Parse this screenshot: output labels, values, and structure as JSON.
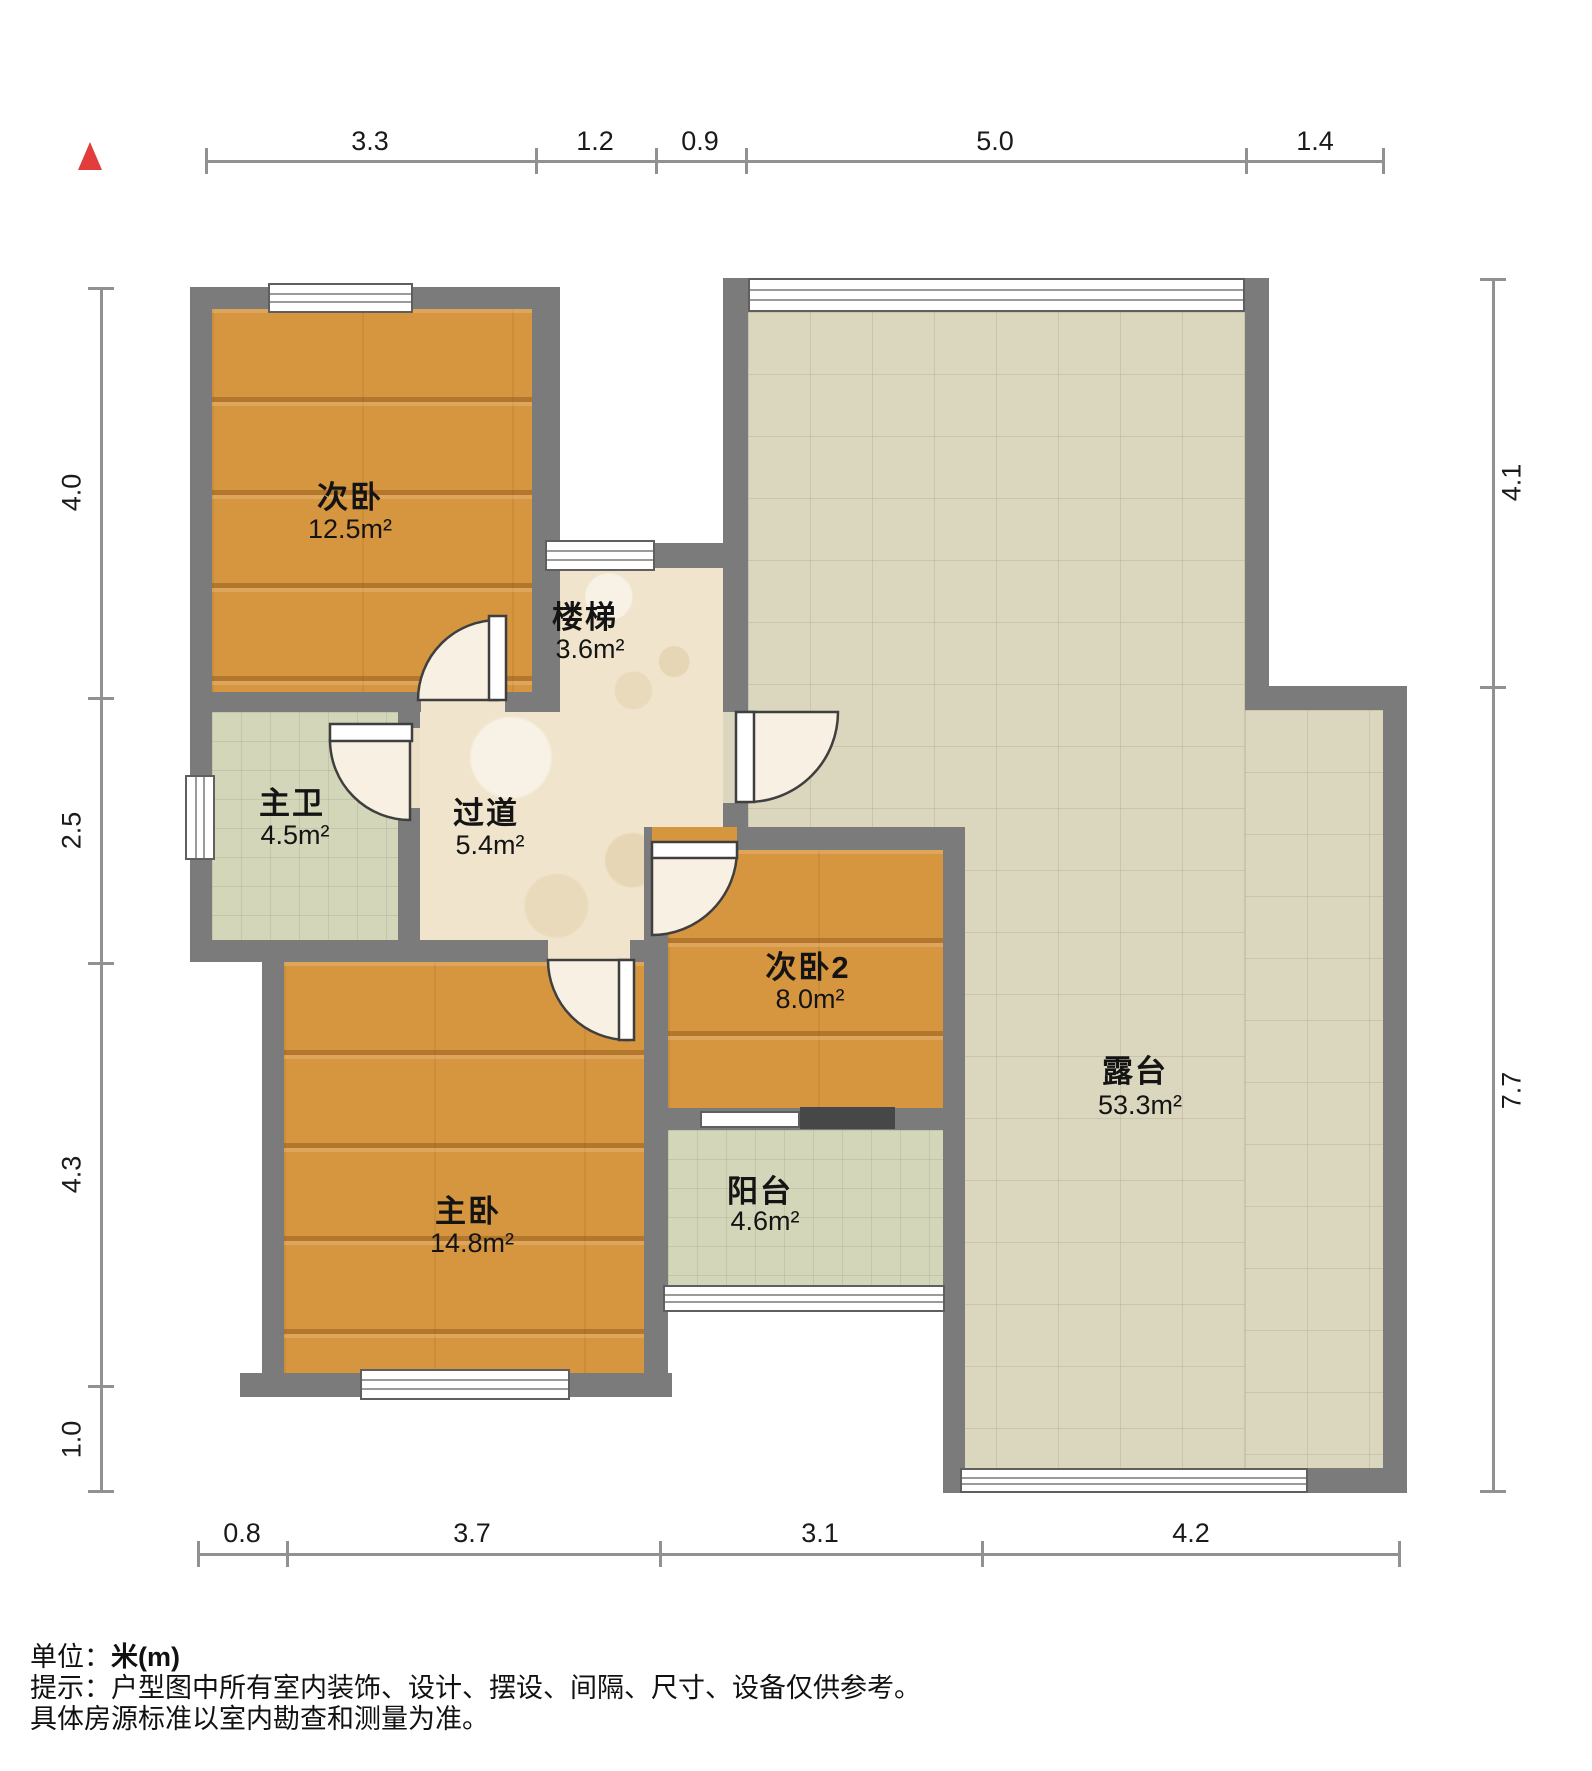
{
  "rooms": {
    "bedroom2": {
      "name": "次卧",
      "area": "12.5m²"
    },
    "stairs": {
      "name": "楼梯",
      "area": "3.6m²"
    },
    "master_bath": {
      "name": "主卫",
      "area": "4.5m²"
    },
    "corridor": {
      "name": "过道",
      "area": "5.4m²"
    },
    "bedroom3": {
      "name": "次卧2",
      "area": "8.0m²"
    },
    "master_bedroom": {
      "name": "主卧",
      "area": "14.8m²"
    },
    "balcony": {
      "name": "阳台",
      "area": "4.6m²"
    },
    "terrace": {
      "name": "露台",
      "area": "53.3m²"
    }
  },
  "dimensions": {
    "top": [
      "3.3",
      "1.2",
      "0.9",
      "5.0",
      "1.4"
    ],
    "left": [
      "4.0",
      "2.5",
      "4.3",
      "1.0"
    ],
    "right": [
      "4.1",
      "7.7"
    ],
    "bottom": [
      "0.8",
      "3.7",
      "3.1",
      "4.2"
    ]
  },
  "footer": {
    "unit_prefix": "单位：",
    "unit_value": "米(m)",
    "tip_line1": "提示：户型图中所有室内装饰、设计、摆设、间隔、尺寸、设备仅供参考。",
    "tip_line2": "具体房源标准以室内勘查和测量为准。"
  },
  "colors": {
    "wall": "#7b7b7b",
    "wood_floor": "#d6953f",
    "marble_floor": "#f0e5cc",
    "tile_floor": "#d4d6ba",
    "terrace_floor": "#dbd6be",
    "north_arrow": "#e23c3c",
    "dimension_line": "#919191"
  }
}
